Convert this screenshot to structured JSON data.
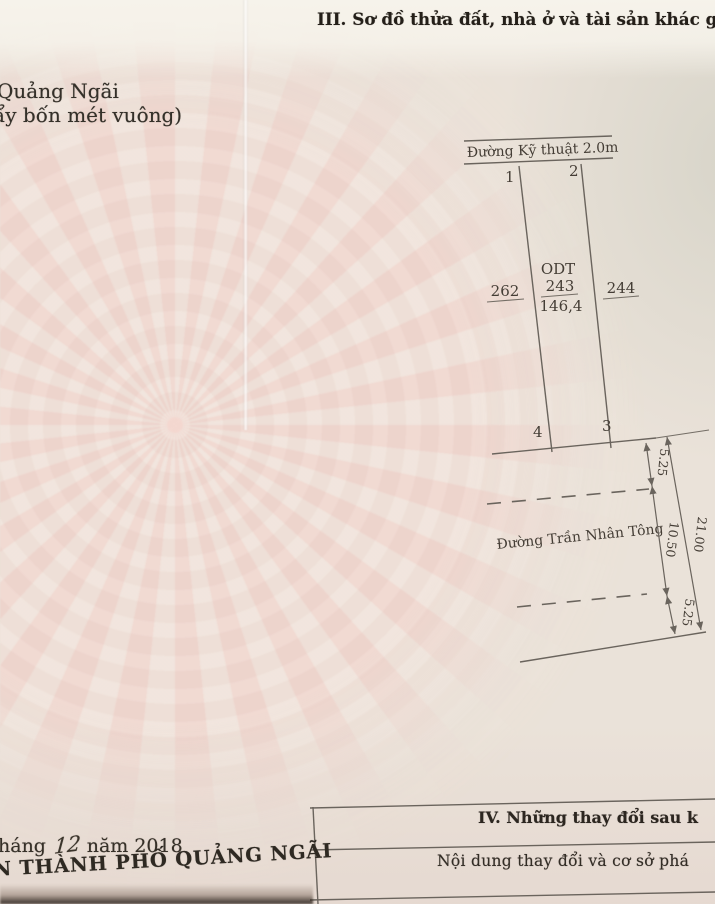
{
  "page": {
    "section_heading": "III. Sơ đồ thửa đất, nhà ở và tài sản khác gắn",
    "left_text_line1": "Quảng Ngãi",
    "left_text_line2": "ẩy bốn mét vuông)"
  },
  "diagram": {
    "road_top_label": "Đường Kỹ thuật 2.0m",
    "corner_1": "1",
    "corner_2": "2",
    "corner_3": "3",
    "corner_4": "4",
    "parcel_left_number": "262",
    "parcel_code": "ODT",
    "parcel_number": "243",
    "parcel_area": "146,4",
    "parcel_right_number": "244",
    "street_label": "Đường Trần Nhân Tông",
    "dim_top": "5.25",
    "dim_middle": "10.50",
    "dim_bottom": "5.25",
    "dim_total": "21.00"
  },
  "footer": {
    "section_iv_heading": "IV. Những thay đổi sau k",
    "table_col_header": "Nội dung thay đổi và cơ sở phá",
    "date_prefix": "háng",
    "date_handwritten": "12",
    "date_suffix": "năm 2018",
    "issuer": "N THÀNH PHỐ QUẢNG NGÃI"
  },
  "colors": {
    "paper": "#eae2d9",
    "pattern_pink": "#f1c8c1",
    "ink": "#3a342c",
    "line": "#6a645d"
  }
}
